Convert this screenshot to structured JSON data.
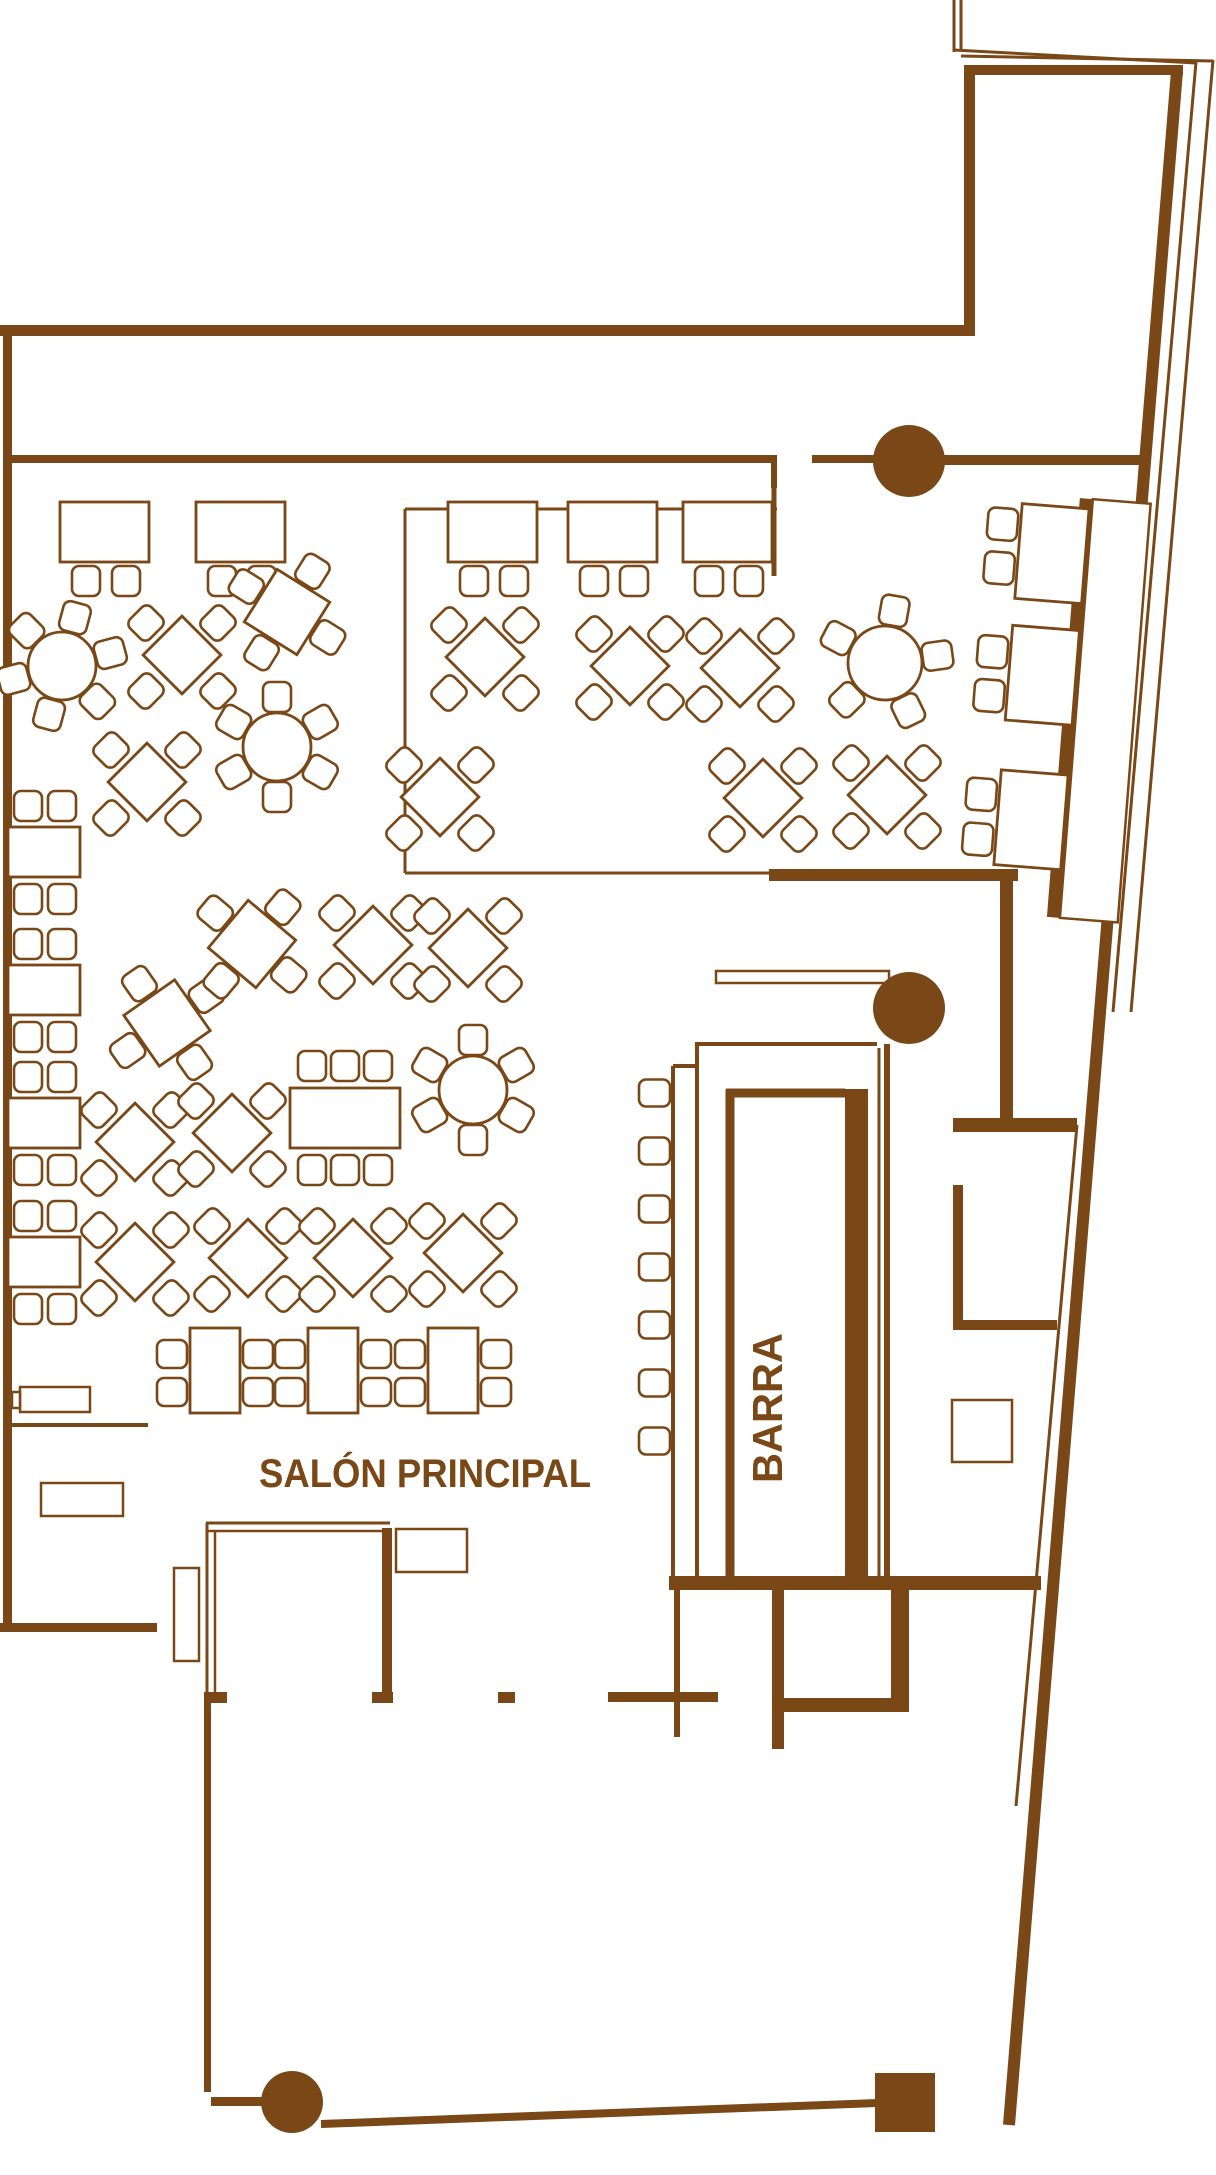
{
  "colors": {
    "ink": "#7a4817",
    "bg": "#ffffff"
  },
  "labels": {
    "hall": "SALÓN PRINCIPAL",
    "bar": "BARRA"
  },
  "canvas": {
    "w": 1216,
    "h": 2175
  },
  "floorplan": {
    "walls": [
      [
        0,
        325,
        975,
        11
      ],
      [
        964,
        65,
        11,
        271
      ],
      [
        964,
        65,
        219,
        10
      ],
      [
        3,
        336,
        9,
        1296
      ],
      [
        0,
        1623,
        157,
        9
      ],
      [
        12,
        455,
        761,
        8
      ],
      [
        771,
        455,
        6,
        33
      ],
      [
        812,
        455,
        63,
        8
      ],
      [
        943,
        455,
        204,
        10
      ],
      [
        769,
        869,
        249,
        12
      ],
      [
        1000,
        881,
        13,
        239
      ],
      [
        953,
        1118,
        124,
        14
      ],
      [
        953,
        1185,
        10,
        145
      ],
      [
        953,
        1320,
        104,
        10
      ],
      [
        669,
        1576,
        372,
        14
      ],
      [
        772,
        1590,
        12,
        159
      ],
      [
        891,
        1590,
        18,
        122
      ],
      [
        784,
        1698,
        125,
        14
      ],
      [
        674,
        1590,
        6,
        147
      ],
      [
        498,
        1692,
        17,
        11
      ],
      [
        608,
        1692,
        110,
        10
      ],
      [
        204,
        1692,
        23,
        11
      ],
      [
        372,
        1692,
        21,
        11
      ],
      [
        382,
        1528,
        10,
        164
      ],
      [
        204,
        1703,
        7,
        389
      ],
      [
        211,
        2097,
        52,
        9
      ],
      [
        875,
        2073,
        60,
        59
      ],
      [
        845,
        1089,
        23,
        487
      ]
    ],
    "lines": [
      [
        405,
        509,
        405,
        873,
        3
      ],
      [
        405,
        509,
        777,
        509,
        3
      ],
      [
        405,
        873,
        769,
        873,
        3
      ],
      [
        774,
        462,
        774,
        576,
        5
      ],
      [
        1177,
        71,
        1009,
        2125,
        12
      ],
      [
        1077,
        1125,
        1016,
        1806,
        3
      ],
      [
        1196,
        62,
        1113,
        1012,
        3
      ],
      [
        1213,
        60,
        1131,
        1012,
        3
      ],
      [
        954,
        0,
        954,
        52,
        3
      ],
      [
        961,
        0,
        961,
        49,
        3
      ],
      [
        954,
        50,
        1196,
        63,
        3
      ],
      [
        961,
        56,
        1213,
        61,
        3
      ],
      [
        321,
        2124,
        877,
        2103,
        8
      ],
      [
        697,
        1046,
        697,
        1576,
        4
      ],
      [
        695,
        1044,
        877,
        1044,
        4
      ],
      [
        673,
        1066,
        673,
        1576,
        4
      ],
      [
        673,
        1066,
        697,
        1066,
        4
      ],
      [
        730,
        1089,
        730,
        1576,
        9
      ],
      [
        726,
        1093,
        845,
        1093,
        9
      ],
      [
        879,
        1048,
        879,
        1576,
        3
      ],
      [
        887,
        1044,
        887,
        1576,
        6
      ],
      [
        206,
        1523,
        390,
        1523,
        3
      ],
      [
        206,
        1531,
        385,
        1531,
        2.5
      ],
      [
        207,
        1523,
        207,
        1692,
        3
      ],
      [
        215,
        1531,
        215,
        1692,
        2.5
      ],
      [
        10,
        1425,
        148,
        1425,
        4
      ],
      [
        952,
        1417,
        1012,
        1417,
        2.5
      ],
      [
        952,
        1445,
        1012,
        1445,
        2.5
      ],
      [
        982,
        1400,
        982,
        1462,
        2.5
      ]
    ],
    "outline_rects": [
      [
        716,
        971,
        173,
        12
      ],
      [
        20,
        1387,
        70,
        25
      ],
      [
        12,
        1392,
        8,
        16
      ],
      [
        41,
        1483,
        82,
        33
      ],
      [
        396,
        1529,
        71,
        43
      ],
      [
        174,
        1568,
        25,
        93
      ],
      [
        952,
        1400,
        60,
        62
      ]
    ],
    "columns": [
      [
        909,
        461,
        36
      ],
      [
        909,
        1008,
        36
      ],
      [
        292,
        2102,
        31
      ]
    ],
    "rect_tables": {
      "xs": [
        60,
        196,
        448,
        568,
        683
      ],
      "y": 502,
      "w": 89,
      "h": 60,
      "chair_y": 566,
      "chair_dx": [
        12,
        52
      ]
    },
    "left_tables": {
      "x": 8,
      "w": 72,
      "h": 50,
      "ys": [
        827,
        965,
        1098,
        1237
      ],
      "chair_dx": [
        6,
        40
      ]
    },
    "six_seat": {
      "x": 290,
      "y": 1088,
      "w": 110,
      "h": 60,
      "chair_dx": [
        8,
        41,
        74
      ]
    },
    "side_tables": {
      "xs": [
        190,
        308,
        428
      ],
      "y": 1328,
      "w": 50,
      "h": 85
    },
    "round_tables": [
      {
        "cx": 62,
        "cy": 666,
        "r": 34,
        "chairs": 6,
        "start": -75,
        "step": 60
      },
      {
        "cx": 277,
        "cy": 747,
        "r": 34,
        "chairs": 6,
        "start": -90,
        "step": 60
      },
      {
        "cx": 473,
        "cy": 1090,
        "r": 34,
        "chairs": 6,
        "start": -90,
        "step": 60
      },
      {
        "cx": 885,
        "cy": 663,
        "r": 37,
        "chairs": 5,
        "start": -80,
        "step": 72
      }
    ],
    "diamonds": [
      [
        182,
        655
      ],
      [
        485,
        657
      ],
      [
        630,
        666
      ],
      [
        740,
        668
      ],
      [
        440,
        797
      ],
      [
        763,
        798
      ],
      [
        887,
        795
      ],
      [
        373,
        945
      ],
      [
        468,
        948
      ],
      [
        147,
        782
      ],
      [
        135,
        1142
      ],
      [
        232,
        1133
      ],
      [
        135,
        1262
      ],
      [
        248,
        1258
      ],
      [
        353,
        1258
      ],
      [
        463,
        1253
      ]
    ],
    "tilted_tables": [
      [
        287,
        612,
        32
      ],
      [
        167,
        1023,
        -35
      ],
      [
        252,
        944,
        40
      ]
    ],
    "banquette": {
      "rot": 4.5,
      "ox": 1070,
      "oy": 700,
      "bench_fill": [
        1064,
        498,
        13,
        420
      ],
      "bench_rect": [
        1077,
        498,
        58,
        420
      ],
      "table_x": 1007,
      "table_w": 67,
      "table_h": 95,
      "table_ys": [
        508,
        630,
        775
      ],
      "chair_x": 974,
      "chair_ys": [
        514,
        558,
        642,
        686,
        785,
        830
      ]
    },
    "stools": {
      "x": 639,
      "w": 31,
      "h": 27,
      "cys": [
        1093,
        1151,
        1209,
        1267,
        1325,
        1383,
        1441
      ]
    },
    "text_layout": {
      "hall": {
        "x": 425,
        "y": 1487,
        "size": 40,
        "len": 332
      },
      "bar": {
        "x": 782,
        "y": 1408,
        "size": 42,
        "len": 150
      }
    }
  }
}
